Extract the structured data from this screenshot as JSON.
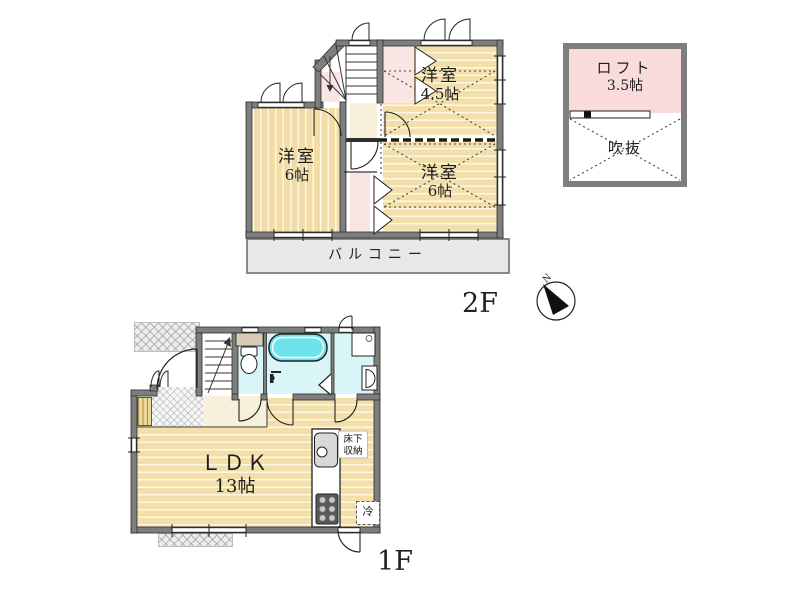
{
  "floor2": {
    "label": "2F",
    "room_west": {
      "name": "洋室",
      "size": "6帖"
    },
    "room_northeast": {
      "name": "洋室",
      "size": "4.5帖"
    },
    "room_southeast": {
      "name": "洋室",
      "size": "6帖"
    },
    "balcony": "バルコニー"
  },
  "loft": {
    "name": "ロフト",
    "size": "3.5帖",
    "void": "吹抜"
  },
  "floor1": {
    "label": "1F",
    "ldk": {
      "name": "ＬＤＫ",
      "size": "13帖"
    },
    "floor_storage": {
      "line1": "床下",
      "line2": "収納"
    },
    "fridge": "冷"
  },
  "compass": {
    "north": "N"
  },
  "colors": {
    "floor_tan": "#f1dda5",
    "closet_pink": "#fbe5e4",
    "loft_pink": "#f8dbda",
    "wet_area_cyan": "#d9f5f7",
    "bathtub_cyan": "#6fe3ec",
    "wall_gray": "#7e7e7e",
    "balcony_gray": "#e8e8e8"
  }
}
